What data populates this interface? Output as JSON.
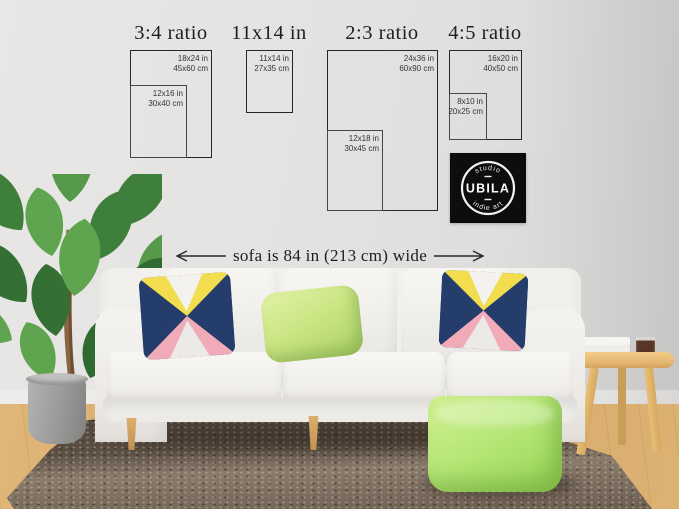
{
  "size_guide": {
    "groups": [
      {
        "title": "3:4 ratio",
        "frames": [
          {
            "inches": "18x24 in",
            "cm": "45x60 cm"
          },
          {
            "inches": "12x16 in",
            "cm": "30x40 cm"
          }
        ]
      },
      {
        "title": "11x14 in",
        "frames": [
          {
            "inches": "11x14 in",
            "cm": "27x35 cm"
          }
        ]
      },
      {
        "title": "2:3 ratio",
        "frames": [
          {
            "inches": "24x36 in",
            "cm": "60x90 cm"
          },
          {
            "inches": "12x18 in",
            "cm": "30x45 cm"
          }
        ]
      },
      {
        "title": "4:5 ratio",
        "frames": [
          {
            "inches": "16x20 in",
            "cm": "40x50 cm"
          },
          {
            "inches": "8x10 in",
            "cm": "20x25 cm"
          }
        ]
      }
    ],
    "sofa_width_label": "sofa is 84 in (213 cm) wide"
  },
  "brand_badge": {
    "top_text": "studio",
    "name": "UBILA",
    "bottom_text": "indie art"
  },
  "colors": {
    "frame_outline": "#272727",
    "badge_background": "#0d0d0d",
    "pillow_navy": "#243d6b",
    "pillow_yellow": "#f2dd4e",
    "pillow_pink": "#f0aab8",
    "pillow_green": "#c3e27f",
    "pouf_green": "#a9e06c",
    "rug_brown": "#6e6052",
    "wood_floor": "#dcb273",
    "table_wood": "#e7bd74",
    "wall_gray": "#e2e1df",
    "sofa_white": "#f3f2ef",
    "plant_green": "#4f8f45"
  }
}
